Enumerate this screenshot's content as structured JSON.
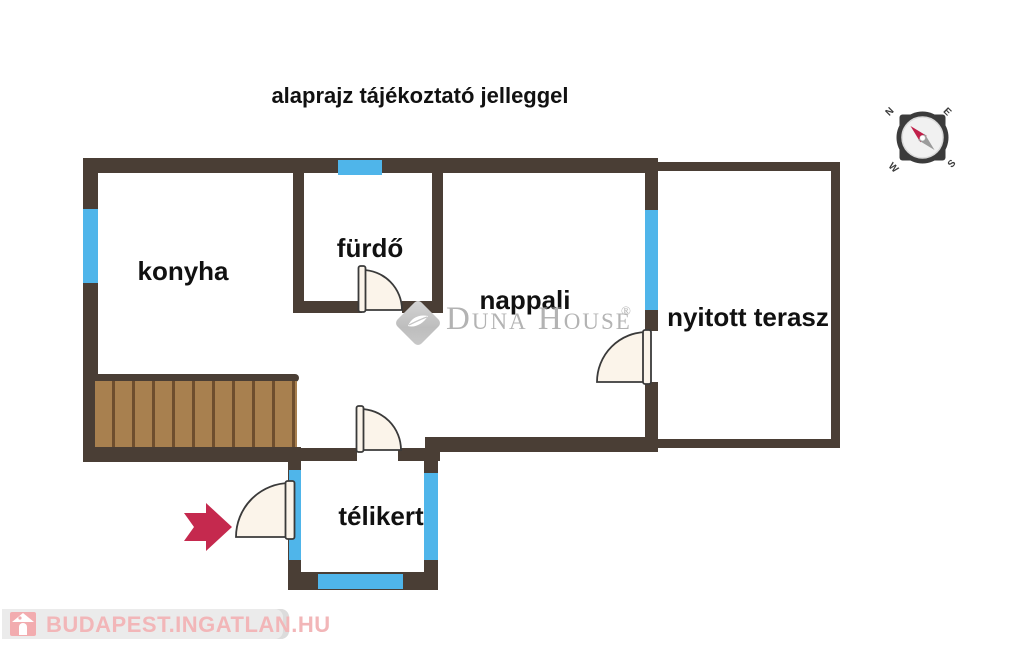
{
  "title": "alaprajz tájékoztató jelleggel",
  "rooms": {
    "konyha": "konyha",
    "furdo": "fürdő",
    "nappali": "nappali",
    "terasz": "nyitott terasz",
    "telikert": "télikert"
  },
  "compass": {
    "n": "N",
    "e": "E",
    "s": "S",
    "w": "W"
  },
  "brand": {
    "name": "Duna House",
    "registered": "®"
  },
  "footer": {
    "site": "BUDAPEST.INGATLAN.HU"
  },
  "colors": {
    "wall": "#4A3E35",
    "window": "#4FB5EA",
    "door-fill": "#FBF4EA",
    "door-stroke": "#3A3A3A",
    "wood": "#A8804F",
    "wood-line": "#6E4E2E",
    "arrow": "#C5294E",
    "brand-gray": "#B3B3B3",
    "footer-bg": "#EBEBEB",
    "footer-pink": "#F2B6B8",
    "footer-icon": "#F2ACAF",
    "compass-dark": "#3B3B3B",
    "needle-red": "#C0204A",
    "label": "#111111"
  }
}
